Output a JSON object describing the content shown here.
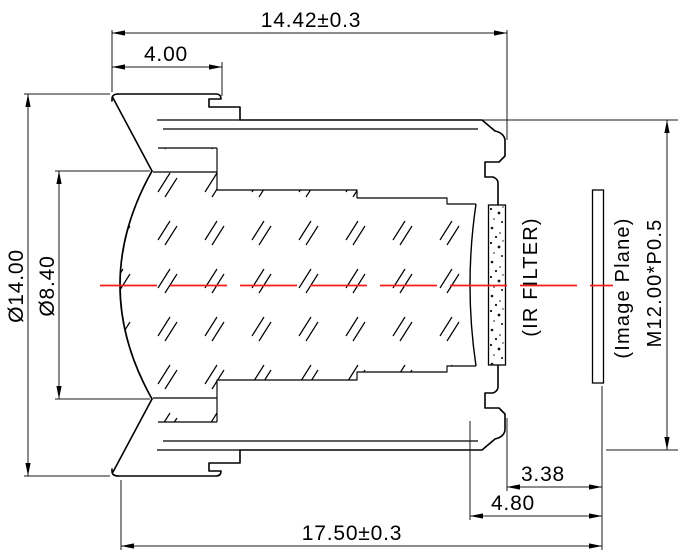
{
  "drawing": {
    "type": "lens-cross-section-technical-drawing",
    "part": "M12 board lens assembly",
    "colors": {
      "outline": "#000000",
      "dimension_lines": "#1a1a1a",
      "centerline": "#fb1b1b",
      "background": "#ffffff"
    },
    "dims": {
      "overall_front_to_thread_end": "14.42±0.3",
      "flange_thickness": "4.00",
      "outer_diameter": "Ø14.00",
      "front_aperture_diameter": "Ø8.40",
      "thread_end_to_image_plane": "3.38",
      "filter_seat_to_image_plane": "4.80",
      "total_track_length": "17.50±0.3",
      "thread_spec": "M12.00*P0.5"
    },
    "labels": {
      "ir_filter": "(IR FILTER)",
      "image_plane": "(Image Plane)"
    }
  }
}
